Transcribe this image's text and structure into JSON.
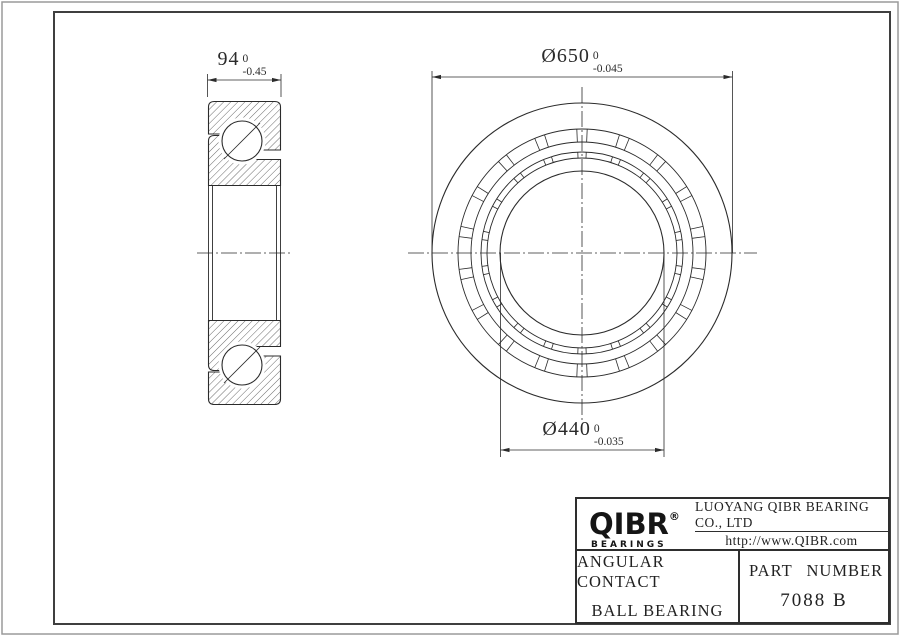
{
  "drawing": {
    "dim_width": {
      "value": "94",
      "tol_upper": "0",
      "tol_lower": "-0.45"
    },
    "dim_outer": {
      "value": "Ø650",
      "tol_upper": "0",
      "tol_lower": "-0.045"
    },
    "dim_bore": {
      "value": "Ø440",
      "tol_upper": "0",
      "tol_lower": "-0.035"
    }
  },
  "title_block": {
    "logo_text": "QIBR",
    "logo_registered": "®",
    "logo_sub": "BEARINGS",
    "company": "LUOYANG QIBR BEARING CO., LTD",
    "website": "http://www.QIBR.com",
    "product_line1": "ANGULAR CONTACT",
    "product_line2": "BALL BEARING",
    "part_label": "PART NUMBER",
    "part_number": "7088 B"
  },
  "colors": {
    "line": "#2b2b2b",
    "frame": "#3f3f3f",
    "page_border": "#9a9a9a"
  }
}
